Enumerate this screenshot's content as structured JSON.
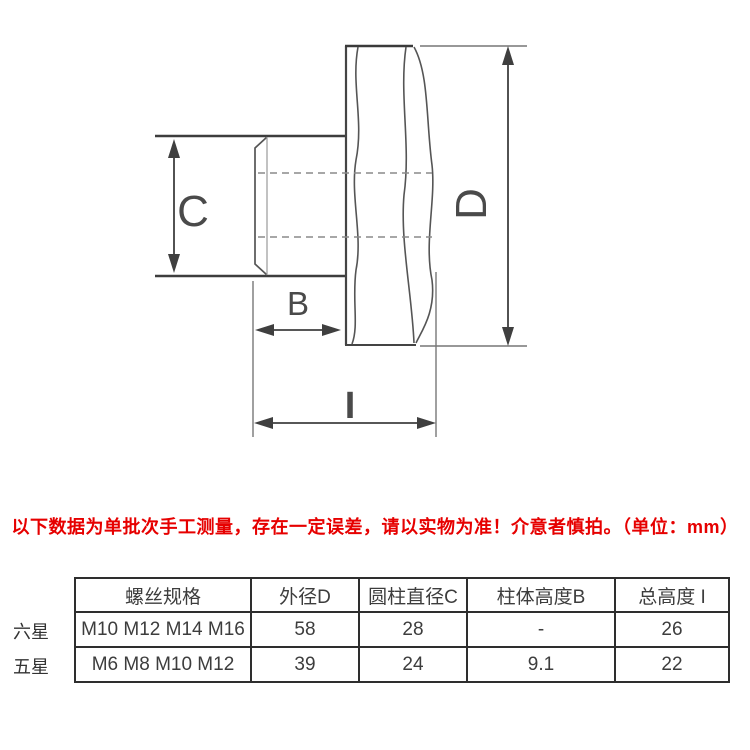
{
  "drawing": {
    "labels": {
      "c": "C",
      "b": "B",
      "d": "D",
      "i": "I"
    }
  },
  "note": {
    "text": "以下数据为单批次手工测量，存在一定误差，请以实物为准！介意者慎拍。（单位：mm）",
    "color": "#e60000"
  },
  "spec_table": {
    "headers": [
      "螺丝规格",
      "外径D",
      "圆柱直径C",
      "柱体高度B",
      "总高度 I"
    ],
    "rows": [
      {
        "label": "六星",
        "cells": [
          "M10 M12 M14 M16",
          "58",
          "28",
          "-",
          "26"
        ]
      },
      {
        "label": "五星",
        "cells": [
          "M6 M8 M10 M12",
          "39",
          "24",
          "9.1",
          "22"
        ]
      }
    ]
  }
}
